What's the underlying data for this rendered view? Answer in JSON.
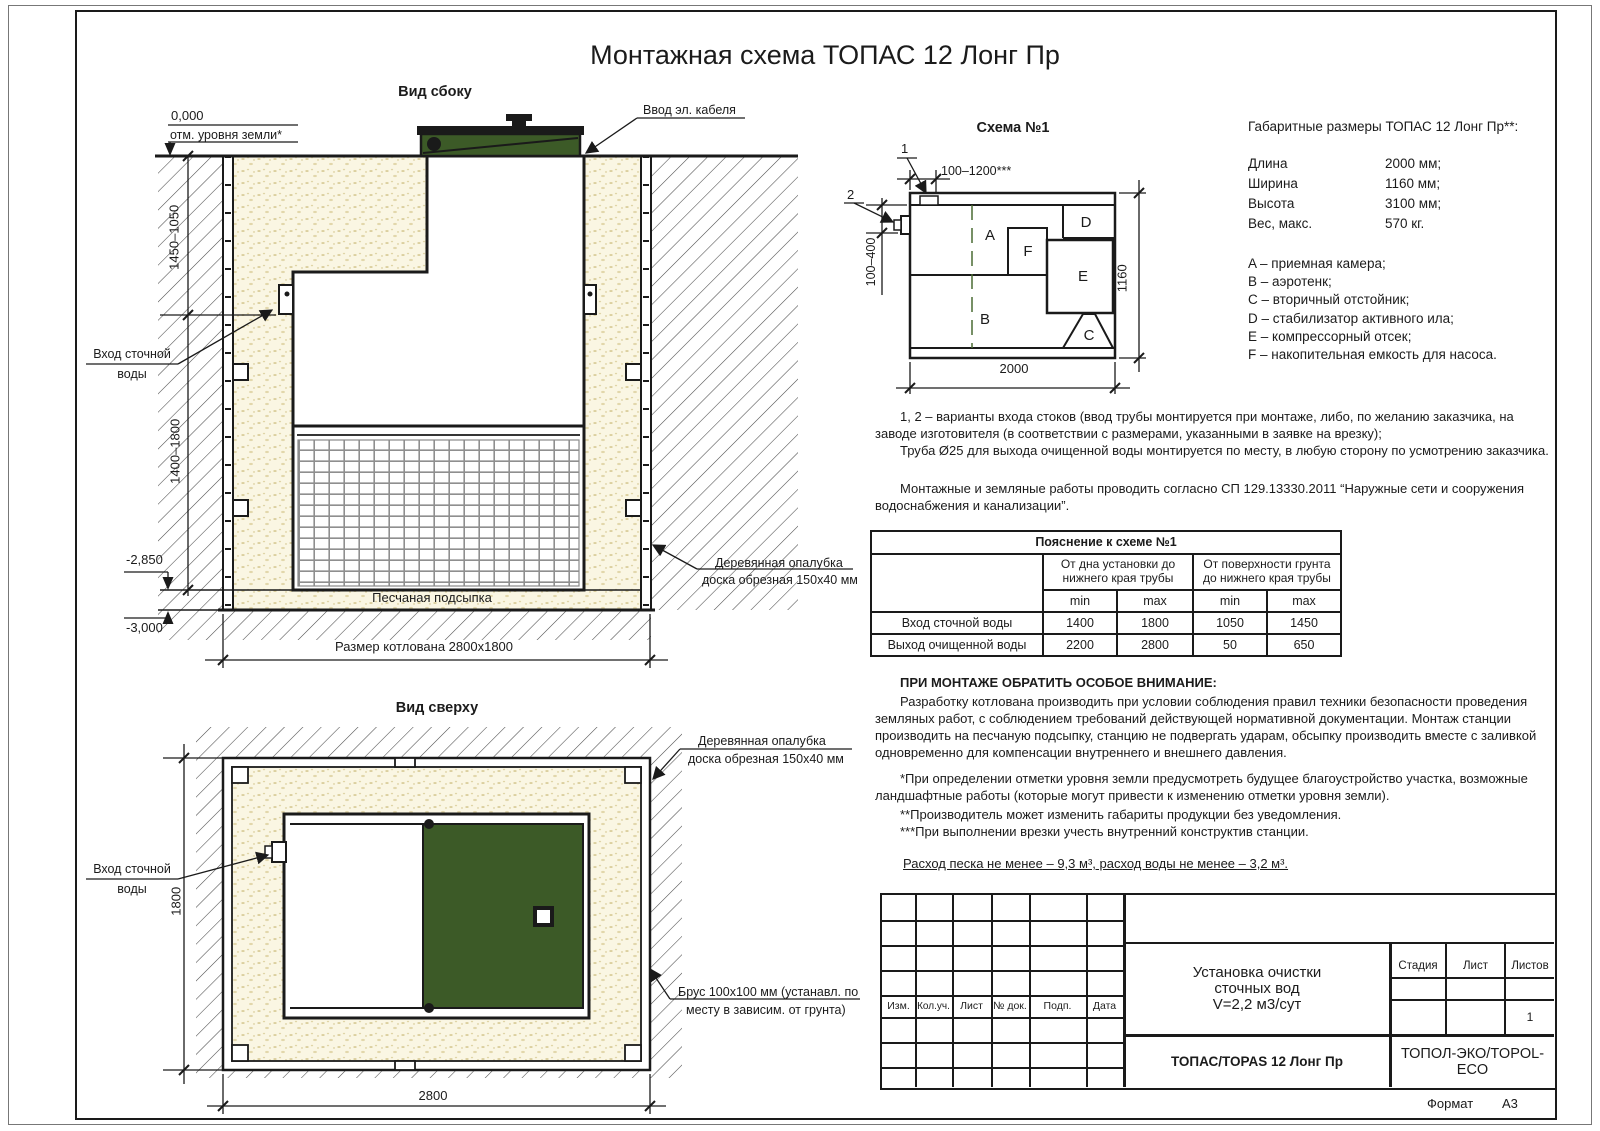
{
  "colors": {
    "lid_green": "#3c5a27",
    "sand_fill": "#faf6e3",
    "line_color": "#1a1a1a",
    "dashed_green": "#4a6b33"
  },
  "page": {
    "title": "Монтажная схема ТОПАС 12 Лонг Пр"
  },
  "side_view": {
    "title": "Вид сбоку",
    "zero_mark": "0,000",
    "ground_note": "отм. уровня земли*",
    "cable_label": "Ввод эл. кабеля",
    "dim_upper": "1450–1050",
    "dim_lower": "1400–1800",
    "inlet_label_1": "Вход сточной",
    "inlet_label_2": "воды",
    "level_tank_bottom": "-2,850",
    "level_pit_bottom": "-3,000",
    "formwork_label_1": "Деревянная опалубка",
    "formwork_label_2": "доска обрезная 150x40 мм",
    "sand_bed_label": "Песчаная подсыпка",
    "pit_dim_label": "Размер котлована 2800x1800"
  },
  "top_view": {
    "title": "Вид сверху",
    "formwork_label_1": "Деревянная опалубка",
    "formwork_label_2": "доска обрезная 150x40 мм",
    "inlet_label_1": "Вход сточной",
    "inlet_label_2": "воды",
    "beam_label_1": "Брус 100x100 мм (устанавл. по",
    "beam_label_2": "месту в зависим. от грунта)",
    "dim_height": "1800",
    "dim_width": "2800"
  },
  "schema": {
    "title": "Схема №1",
    "marker_1": "1",
    "marker_2": "2",
    "dim_top": "100–1200***",
    "dim_left": "100–400",
    "dim_bottom": "2000",
    "dim_right": "1160",
    "comp_a": "A",
    "comp_b": "B",
    "comp_c": "C",
    "comp_d": "D",
    "comp_e": "E",
    "comp_f": "F"
  },
  "specs": {
    "heading": "Габаритные размеры ТОПАС 12 Лонг Пр**:",
    "rows": [
      {
        "label": "Длина",
        "value": "2000 мм;"
      },
      {
        "label": "Ширина",
        "value": "1160 мм;"
      },
      {
        "label": "Высота",
        "value": "3100 мм;"
      },
      {
        "label": "Вес, макс.",
        "value": "570 кг."
      }
    ],
    "legend": [
      "A – приемная камера;",
      "B – аэротенк;",
      "C – вторичный отстойник;",
      "D – стабилизатор активного ила;",
      "E – компрессорный отсек;",
      "F – накопительная емкость для насоса."
    ]
  },
  "notes": {
    "p1": "1, 2 – варианты входа  стоков (ввод трубы монтируется при монтаже, либо, по желанию заказчика, на заводе изготовителя (в соответствии с размерами, указанными в заявке на врезку);",
    "p2": "Труба Ø25 для выхода очищенной воды монтируется по месту, в любую сторону по усмотрению заказчика.",
    "p3": "Монтажные и земляные работы проводить согласно СП 129.13330.2011 “Наружные сети и сооружения водоснабжения и канализации”."
  },
  "explanation_table": {
    "title": "Пояснение к схеме №1",
    "col_group_1": "От дна установки до нижнего края трубы",
    "col_group_2": "От поверхности грунта до нижнего края трубы",
    "min": "min",
    "max": "max",
    "rows": [
      {
        "label": "Вход сточной воды",
        "v1": "1400",
        "v2": "1800",
        "v3": "1050",
        "v4": "1450"
      },
      {
        "label": "Выход очищенной воды",
        "v1": "2200",
        "v2": "2800",
        "v3": "50",
        "v4": "650"
      }
    ]
  },
  "attention": {
    "heading": "ПРИ МОНТАЖЕ ОБРАТИТЬ ОСОБОЕ ВНИМАНИЕ:",
    "body": "Разработку котлована производить при условии соблюдения правил техники безопасности проведения земляных работ, с соблюдением требований действующей нормативной документации. Монтаж станции производить на песчаную подсыпку, станцию не подвергать ударам, обсыпку производить вместе с заливкой одновременно для компенсации внутреннего и внешнего давления."
  },
  "footnotes": {
    "f1": "*При определении отметки уровня земли предусмотреть будущее благоустройство участка, возможные ландшафтные работы (которые могут привести к изменению отметки уровня земли).",
    "f2": "**Производитель может изменить габариты продукции без уведомления.",
    "f3": "***При выполнении врезки учесть внутренний конструктив станции."
  },
  "consumption": "Расход песка не менее – 9,3 м³, расход воды не менее – 3,2 м³.",
  "stamp": {
    "cols": [
      "Изм.",
      "Кол.уч.",
      "Лист",
      "№ док.",
      "Подп.",
      "Дата"
    ],
    "project_1": "Установка очистки",
    "project_2": "сточных вод",
    "project_3": "V=2,2 м3/сут",
    "model": "ТОПАС/TOPAS 12 Лонг Пр",
    "stage": "Стадия",
    "sheet": "Лист",
    "sheets": "Листов",
    "sheets_value": "1",
    "company": "ТОПОЛ-ЭКО/TOPOL-ECO",
    "format_label": "Формат",
    "format_value": "А3"
  }
}
